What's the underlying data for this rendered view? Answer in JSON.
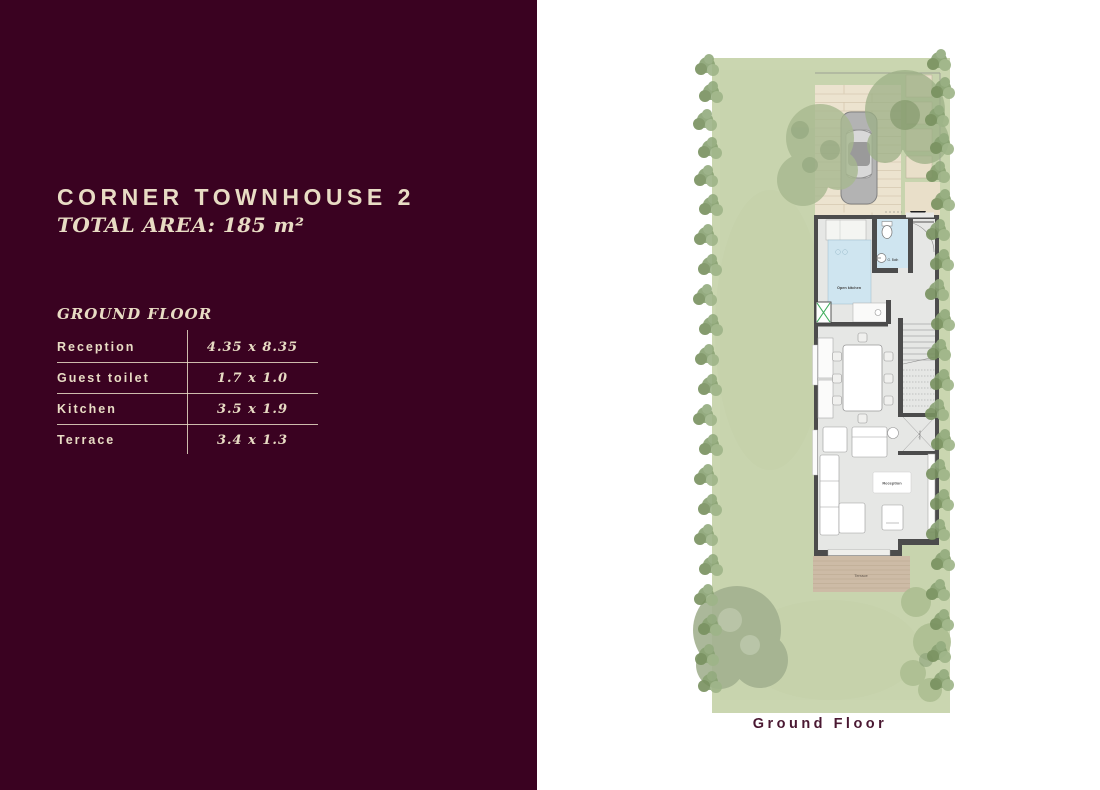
{
  "panel": {
    "background": "#3a0221",
    "text_color": "#e8dcc4",
    "title": "CORNER TOWNHOUSE 2",
    "total_area": "TOTAL AREA: 185 m²",
    "section_heading": "GROUND FLOOR",
    "table": {
      "rows": [
        {
          "label": "Reception",
          "dims": "4.35 x 8.35"
        },
        {
          "label": "Guest toilet",
          "dims": "1.7 x 1.0"
        },
        {
          "label": "Kitchen",
          "dims": "3.5 x 1.9"
        },
        {
          "label": "Terrace",
          "dims": "3.4 x 1.3"
        }
      ]
    }
  },
  "plan": {
    "caption": "Ground Floor",
    "labels": {
      "kitchen": "Open kitchen",
      "guest_bath": "G. Bath",
      "reception": "Reception",
      "terrace": "Terrace",
      "storage": "Storage"
    },
    "colors": {
      "lawn": "#cad6b0",
      "hedge": "#89a273",
      "paving": "#ece3cf",
      "parking_tile": "#e9dfc9",
      "wall": "#4c4c4c",
      "floor": "#e6e7e5",
      "wet_area": "#cfe5f0",
      "terrace_wood": "#cdbba6",
      "caption_color": "#4a1832"
    }
  }
}
